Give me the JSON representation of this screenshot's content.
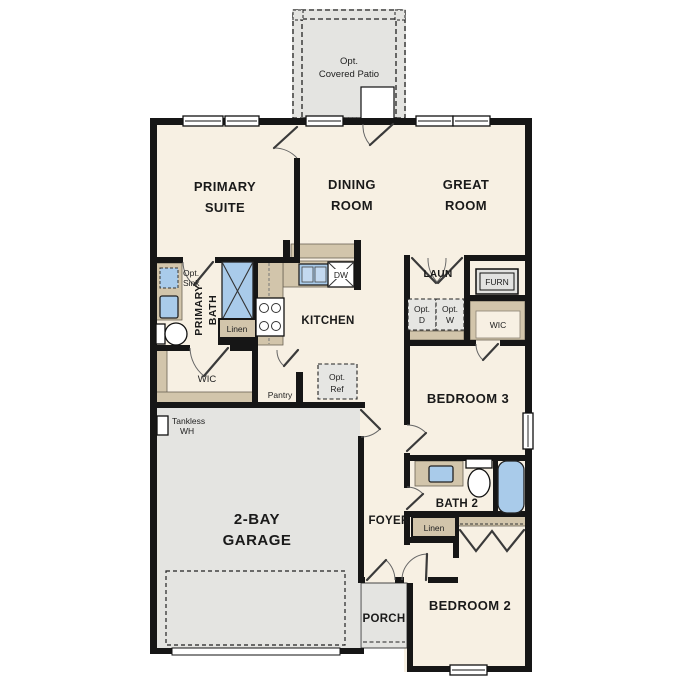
{
  "plan_title": "single-story floor plan",
  "colors": {
    "floor_cream": "#f7f0e3",
    "counter_tan": "#d2c5ab",
    "fixture_blue": "#a9cbea",
    "garage_gray": "#e4e4e1",
    "wall_black": "#161616"
  },
  "rooms": {
    "patio": {
      "line1": "Opt.",
      "line2": "Covered Patio"
    },
    "primary_suite": {
      "line1": "PRIMARY",
      "line2": "SUITE"
    },
    "dining": {
      "line1": "DINING",
      "line2": "ROOM"
    },
    "great": {
      "line1": "GREAT",
      "line2": "ROOM"
    },
    "laundry": {
      "label": "LAUN"
    },
    "furnace": {
      "label": "FURN"
    },
    "opt_dryer": {
      "line1": "Opt.",
      "line2": "D"
    },
    "opt_washer": {
      "line1": "Opt.",
      "line2": "W"
    },
    "wic_right": {
      "label": "WIC"
    },
    "primary_bath": {
      "line1": "PRIMARY",
      "line2": "BATH",
      "opt_sink_line1": "Opt.",
      "opt_sink_line2": "Sink",
      "linen": "Linen"
    },
    "kitchen": {
      "label": "KITCHEN",
      "dishwasher": "DW"
    },
    "wic_left": {
      "label": "WIC"
    },
    "pantry": {
      "label": "Pantry"
    },
    "opt_ref": {
      "line1": "Opt.",
      "line2": "Ref"
    },
    "bedroom3": {
      "label": "BEDROOM 3"
    },
    "garage": {
      "line1": "2-BAY",
      "line2": "GARAGE",
      "wh_line1": "Tankless",
      "wh_line2": "WH"
    },
    "foyer": {
      "label": "FOYER"
    },
    "bath2": {
      "label": "BATH 2",
      "linen": "Linen"
    },
    "porch": {
      "label": "PORCH"
    },
    "bedroom2": {
      "label": "BEDROOM 2"
    }
  }
}
